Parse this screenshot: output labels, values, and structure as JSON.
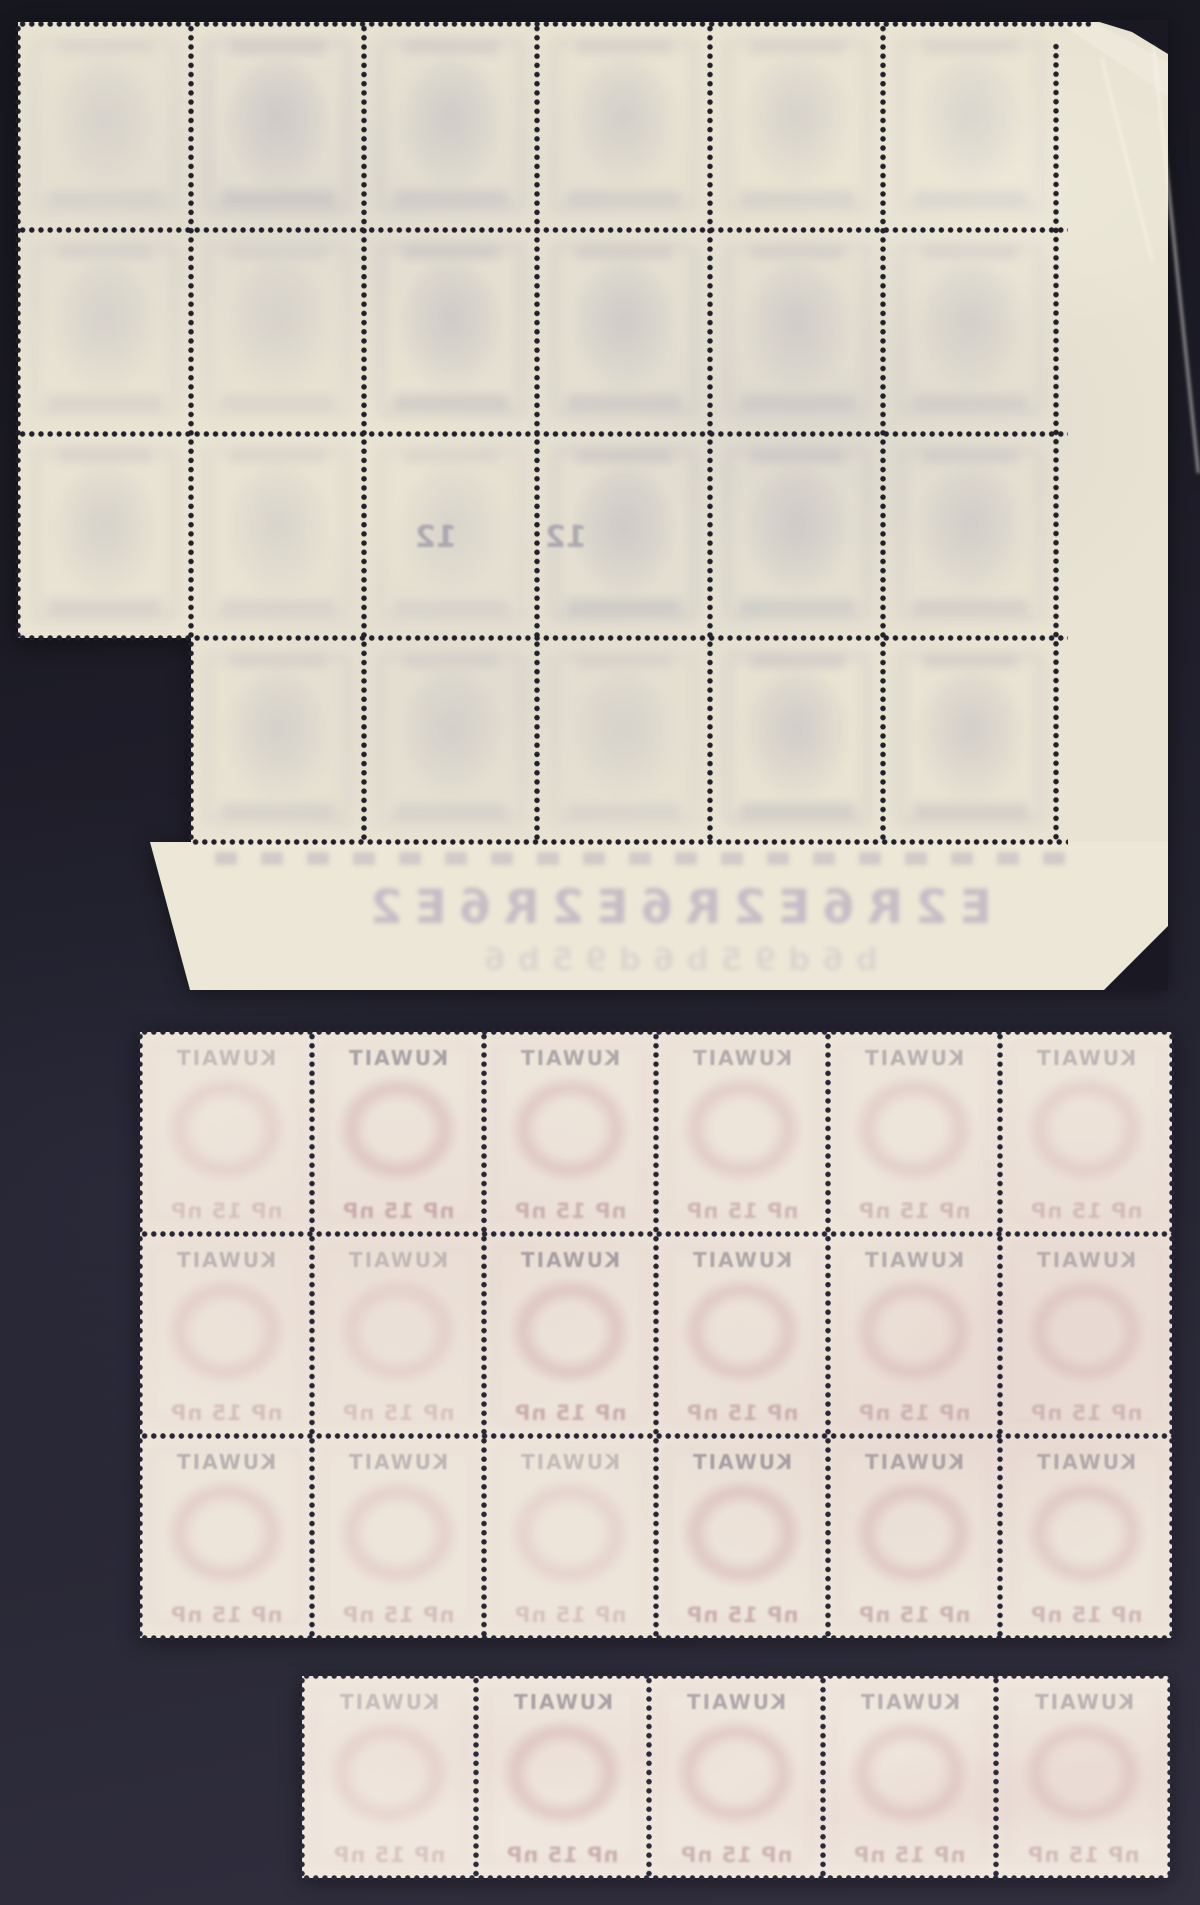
{
  "canvas": {
    "width": 1200,
    "height": 1905,
    "background_top": "#17171f",
    "background_bottom": "#322f3f"
  },
  "perforation": {
    "pitch": 9.2,
    "dot_radius": 2.3
  },
  "sheets": [
    {
      "id": "top-sheet",
      "kind": "large corner block, back of sheet, 6x4 stamps with right and bottom selvage, stepped lower-left, torn upper-right corner",
      "paper_color": "#e8e3d2",
      "selvage_color": "#ece7d6",
      "dot_color": "#201f2a",
      "ghost_template": "grey",
      "pieces": [
        {
          "x": 18,
          "y": 22,
          "w": 1150,
          "h": 616
        },
        {
          "x": 191,
          "y": 638,
          "w": 977,
          "h": 204
        },
        {
          "x": 150,
          "y": 842,
          "w": 1018,
          "h": 148,
          "clip": "polygon(0px 0px, 1018px 0px, 1018px 148px, 40px 148px)",
          "light": true
        }
      ],
      "grid": {
        "x": 18,
        "y": 24,
        "cols": 6,
        "rows": 4,
        "cw": 173.2,
        "ch": 204.5,
        "skip": [
          [
            3,
            0
          ]
        ]
      },
      "perf_h": [
        [
          24,
          18,
          1093
        ],
        [
          230,
          18,
          1068
        ],
        [
          434,
          18,
          1068
        ],
        [
          638,
          18,
          1068
        ],
        [
          842,
          191,
          1068
        ]
      ],
      "perf_v": [
        [
          18,
          24,
          638
        ],
        [
          191,
          24,
          842
        ],
        [
          364,
          24,
          842
        ],
        [
          537,
          24,
          842
        ],
        [
          710,
          24,
          842
        ],
        [
          883,
          24,
          842
        ],
        [
          1056,
          42,
          842
        ]
      ],
      "numbers": [
        {
          "x": 400,
          "y": 520,
          "text": "12"
        },
        {
          "x": 530,
          "y": 520,
          "text": "12"
        }
      ],
      "selvage": {
        "x": 215,
        "y": 880,
        "w": 920,
        "blob_band": {
          "x": 215,
          "y": 852,
          "w": 860
        },
        "lines": [
          {
            "text": "E2R6E2R6E2R6E2",
            "size": 47,
            "opacity": 0.34,
            "dy": 0
          },
          {
            "text": "b6d95b6d95b6",
            "size": 31,
            "opacity": 0.15,
            "dy": 62
          }
        ]
      },
      "tears": {
        "dark": [
          "polygon(1093px 20px, 1168px 20px, 1168px 54px, 1132px 32px)",
          "polygon(1168px 926px, 1168px 990px, 1104px 990px)"
        ],
        "light": [
          "polygon(1058px 22px, 1094px 22px, 1168px 62px, 1168px 96px)"
        ],
        "creases": [
          {
            "x": 1100,
            "y": 58,
            "len": 210,
            "angle": -14
          },
          {
            "x": 1152,
            "y": 46,
            "len": 430,
            "angle": -6
          }
        ]
      }
    },
    {
      "id": "middle-sheet",
      "kind": "block of 18 (6x3), back of sheet showing mirrored KUWAIT overprint show-through",
      "paper_color": "#ede4da",
      "dot_color": "#262533",
      "ghost_template": "rose",
      "pieces": [
        {
          "x": 140,
          "y": 1032,
          "w": 1032,
          "h": 606
        }
      ],
      "grid": {
        "x": 140,
        "y": 1032,
        "cols": 6,
        "rows": 3,
        "cw": 172,
        "ch": 202,
        "skip": []
      },
      "perf_h": [
        [
          1032,
          140,
          1172
        ],
        [
          1234,
          140,
          1172
        ],
        [
          1436,
          140,
          1172
        ],
        [
          1638,
          140,
          1172
        ]
      ],
      "perf_v": [
        [
          140,
          1032,
          1638
        ],
        [
          312,
          1032,
          1638
        ],
        [
          484,
          1032,
          1638
        ],
        [
          656,
          1032,
          1638
        ],
        [
          828,
          1032,
          1638
        ],
        [
          1000,
          1032,
          1638
        ],
        [
          1172,
          1032,
          1638
        ]
      ],
      "labels": {
        "country": "KUWAIT",
        "value": "nP 15 nP"
      }
    },
    {
      "id": "bottom-strip",
      "kind": "horizontal strip of 5, back of sheet showing mirrored KUWAIT overprint show-through",
      "paper_color": "#efe6dd",
      "dot_color": "#2a2937",
      "ghost_template": "rose",
      "pieces": [
        {
          "x": 302,
          "y": 1676,
          "w": 868,
          "h": 202
        }
      ],
      "grid": {
        "x": 302,
        "y": 1676,
        "cols": 5,
        "rows": 1,
        "cw": 173.6,
        "ch": 202,
        "skip": []
      },
      "perf_h": [
        [
          1676,
          302,
          1170
        ],
        [
          1878,
          302,
          1170
        ]
      ],
      "perf_v": [
        [
          302,
          1676,
          1878
        ],
        [
          476,
          1676,
          1878
        ],
        [
          649,
          1676,
          1878
        ],
        [
          823,
          1676,
          1878
        ],
        [
          996,
          1676,
          1878
        ],
        [
          1170,
          1676,
          1878
        ]
      ],
      "labels": {
        "country": "KUWAIT",
        "value": "nP 15 nP"
      }
    }
  ]
}
